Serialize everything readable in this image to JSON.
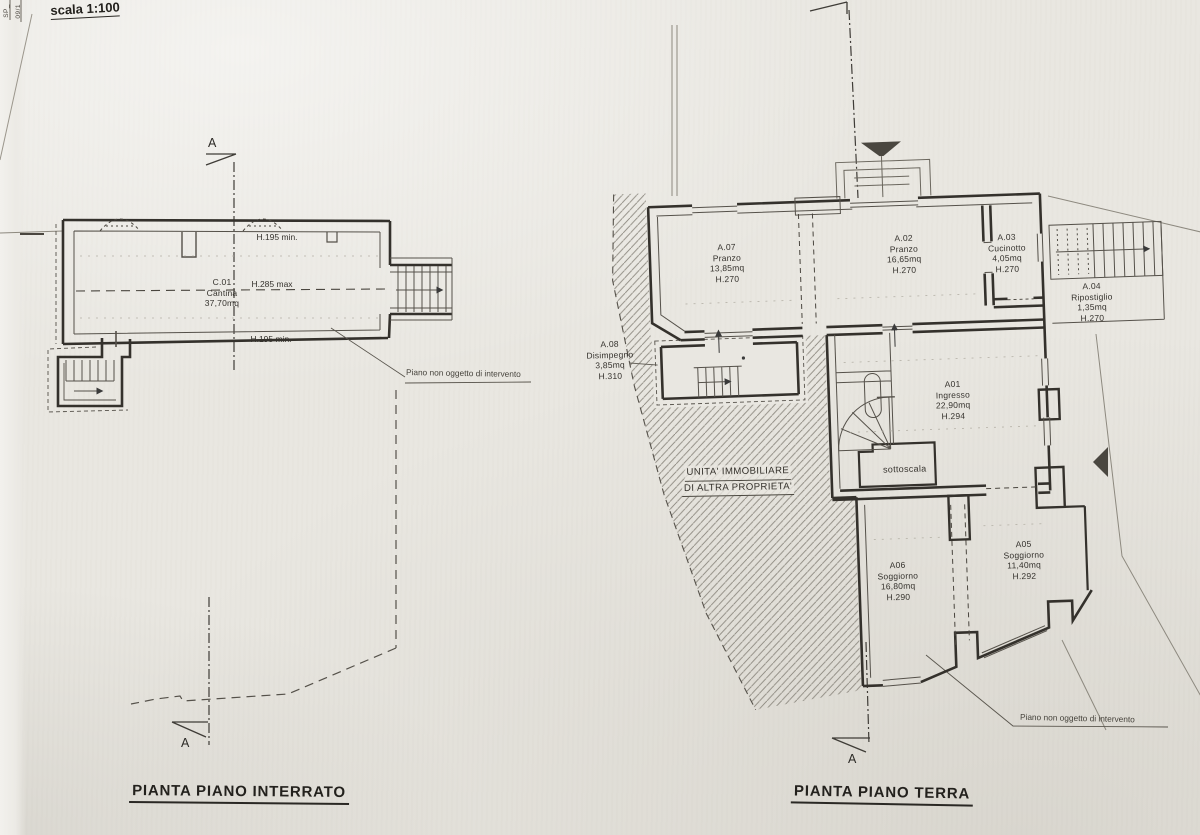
{
  "scale_note": "scala 1:100",
  "edge": {
    "vertical_label_1": "SP_",
    "vertical_label_2": "09/1"
  },
  "colors": {
    "paper": "#e9e7e1",
    "ink": "#3a3a3a",
    "hatch": "#8b877e"
  },
  "plans": {
    "interrato": {
      "title": "PIANTA PIANO INTERRATO",
      "section_letter": "A",
      "rooms": [
        {
          "code": "C.01",
          "name": "Cantina",
          "area": "37,70mq"
        }
      ],
      "annotations": {
        "height_top": "H.195 min.",
        "height_mid": "H.285 max",
        "height_bottom": "H.195 min.",
        "note": "Piano non oggetto di intervento"
      }
    },
    "terra": {
      "title": "PIANTA PIANO TERRA",
      "section_letter": "A",
      "rooms": [
        {
          "code": "A.07",
          "name": "Pranzo",
          "area": "13,85mq",
          "height": "H.270"
        },
        {
          "code": "A.02",
          "name": "Pranzo",
          "area": "16,65mq",
          "height": "H.270"
        },
        {
          "code": "A.03",
          "name": "Cucinotto",
          "area": "4,05mq",
          "height": "H.270"
        },
        {
          "code": "A.04",
          "name": "Ripostiglio",
          "area": "1,35mq",
          "height": "H.270"
        },
        {
          "code": "A.08",
          "name": "Disimpegno",
          "area": "3,85mq",
          "height": "H.310"
        },
        {
          "code": "A01",
          "name": "Ingresso",
          "area": "22,90mq",
          "height": "H.294"
        },
        {
          "code": "A06",
          "name": "Soggiorno",
          "area": "16,80mq",
          "height": "H.290"
        },
        {
          "code": "A05",
          "name": "Soggiorno",
          "area": "11,40mq",
          "height": "H.292"
        }
      ],
      "labels": {
        "sottoscala": "sottoscala",
        "other_property_line1": "UNITA' IMMOBILIARE",
        "other_property_line2": "DI ALTRA PROPRIETA'",
        "note": "Piano non oggetto di intervento"
      }
    }
  }
}
